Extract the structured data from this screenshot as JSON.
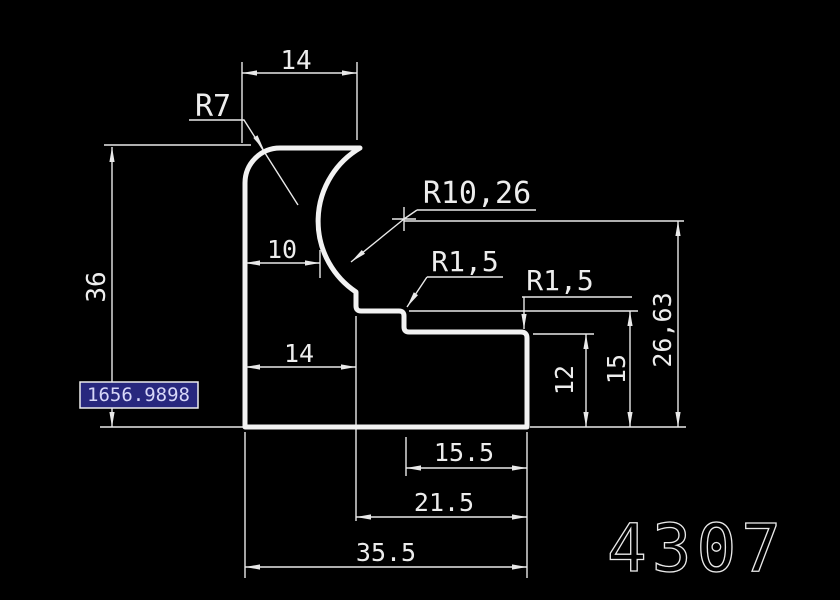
{
  "drawing": {
    "type": "cad-profile-drawing",
    "part_number": "4307",
    "coordinate_input": {
      "value": "1656.9898"
    },
    "labels": {
      "top_width": "14",
      "radius_top_left": "R7",
      "cove_offset": "10",
      "mid_width": "14",
      "left_height": "36",
      "radius_cove": "R10,26",
      "fillet_step": "R1,5",
      "fillet_block": "R1,5",
      "block_inner_height": "12",
      "step_height": "15",
      "center_height": "26,63",
      "block_width": "15.5",
      "lower_width": "21.5",
      "total_width": "35.5"
    },
    "colors": {
      "background": "#000000",
      "line": "#f2f2f2",
      "line_thin": "#e9e9e9",
      "text": "#ededed",
      "input_bg": "#28287e",
      "input_border": "#eeeeee",
      "input_text": "#d8d8f8"
    }
  }
}
